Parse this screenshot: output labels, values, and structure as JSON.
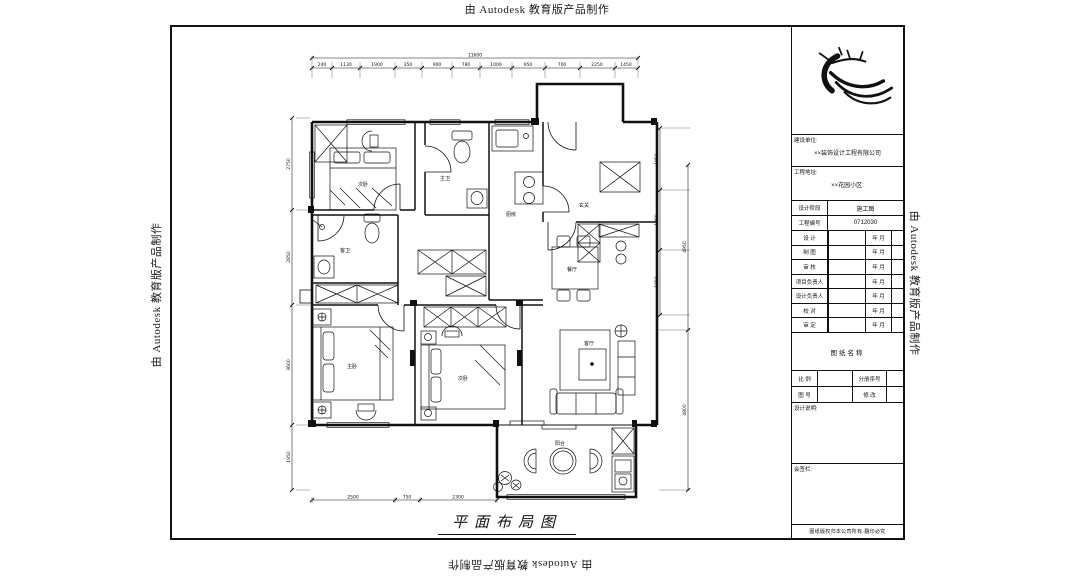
{
  "watermark": {
    "text": "由 Autodesk 教育版产品制作"
  },
  "title_block": {
    "client_label": "建设单位:",
    "client_value": "××装饰设计工程有限公司",
    "address_label": "工程地址:",
    "address_value": "××花园小区:",
    "stage_label": "设计阶段",
    "stage_value": "施工图",
    "no_label": "工程编号",
    "no_value": "0712030",
    "sign_rows": [
      {
        "label": "设 计",
        "date": "年 月"
      },
      {
        "label": "制 图",
        "date": "年 月"
      },
      {
        "label": "审 核",
        "date": "年 月"
      },
      {
        "label": "项目负责人",
        "date": "年 月"
      },
      {
        "label": "设计负责人",
        "date": "年 月"
      },
      {
        "label": "校 对",
        "date": "年 月"
      },
      {
        "label": "审 定",
        "date": "年 月"
      }
    ],
    "drawing_name_header": "图纸名称",
    "scale_label": "比 例",
    "volume_label": "分册序号",
    "fig_no_label": "图 号",
    "revision_label": "修 改",
    "notes_label": "设计说明:",
    "sign_area_label": "会签栏:",
    "footer": "图纸版权归本公司所有·翻印必究"
  },
  "plan": {
    "caption": "平面布局图",
    "rooms": {
      "bedroom_tl": "次卧",
      "bath_master": "主卫",
      "kitchen": "厨房",
      "foyer": "玄关",
      "bath_guest": "客卫",
      "master": "主卧",
      "bedroom_b": "次卧",
      "dining": "餐厅",
      "living": "客厅",
      "balcony": "阳台"
    },
    "dims": {
      "top_overall": "11600",
      "top": [
        "240",
        "1130",
        "1900",
        "350",
        "900",
        "780",
        "1000",
        "950",
        "700",
        "2250",
        "1450"
      ],
      "left": [
        "2750",
        "2850",
        "3600",
        "1950"
      ],
      "right_inner": [
        "1850",
        "1800",
        "1950"
      ],
      "right_outer": [
        "4950",
        "4800"
      ],
      "bottom": [
        "2500",
        "750",
        "2300"
      ]
    }
  }
}
